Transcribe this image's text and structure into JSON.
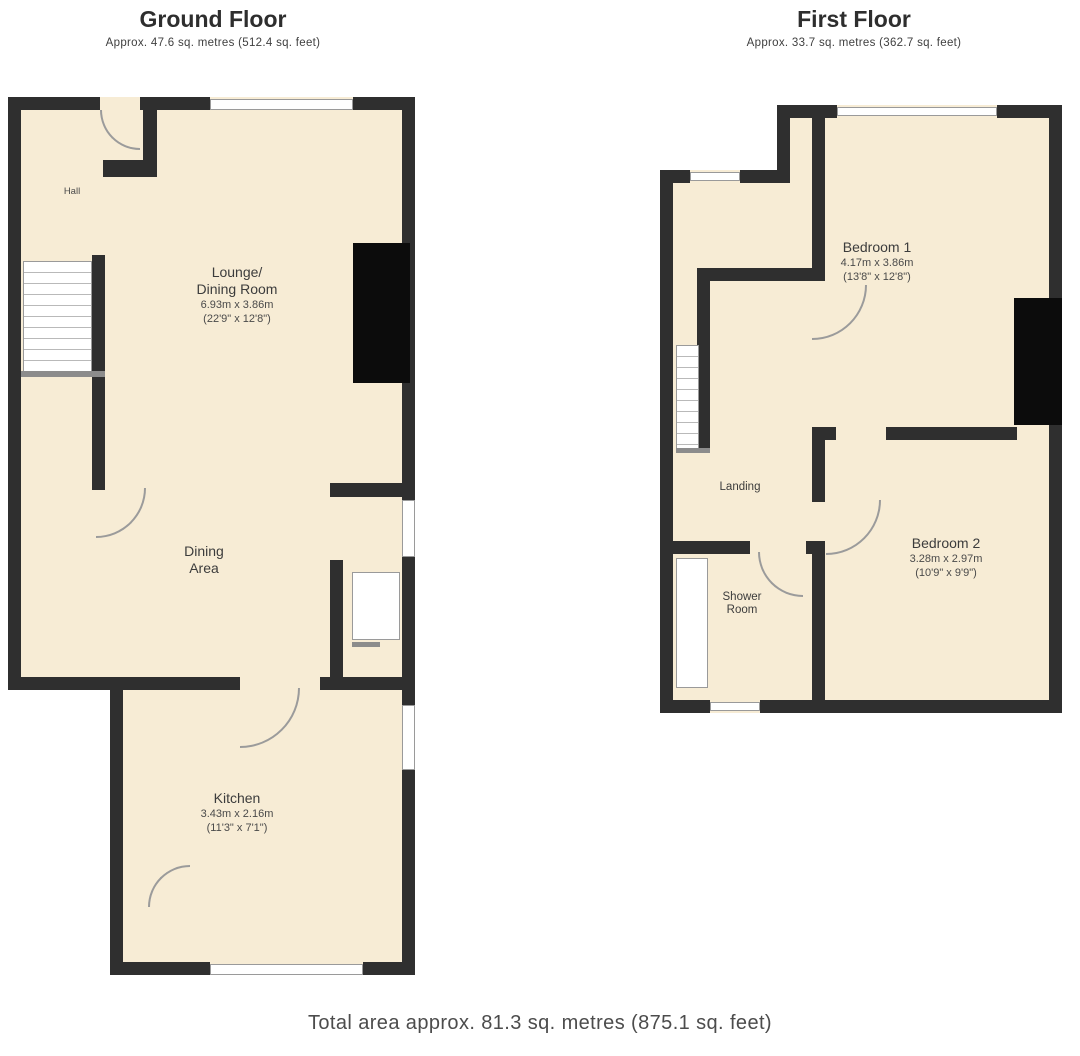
{
  "ground_floor": {
    "title": "Ground Floor",
    "subtitle": "Approx. 47.6 sq. metres (512.4 sq. feet)",
    "hall": {
      "label": "Hall"
    },
    "lounge": {
      "name_line1": "Lounge/",
      "name_line2": "Dining Room",
      "dims_metric": "6.93m x 3.86m",
      "dims_imperial": "(22'9\" x 12'8\")"
    },
    "dining_area": {
      "line1": "Dining",
      "line2": "Area"
    },
    "kitchen": {
      "name": "Kitchen",
      "dims_metric": "3.43m x 2.16m",
      "dims_imperial": "(11'3\" x 7'1\")"
    }
  },
  "first_floor": {
    "title": "First Floor",
    "subtitle": "Approx. 33.7 sq. metres (362.7 sq. feet)",
    "landing": {
      "label": "Landing"
    },
    "bedroom1": {
      "name": "Bedroom 1",
      "dims_metric": "4.17m x 3.86m",
      "dims_imperial": "(13'8\" x 12'8\")"
    },
    "bedroom2": {
      "name": "Bedroom 2",
      "dims_metric": "3.28m x 2.97m",
      "dims_imperial": "(10'9\" x 9'9\")"
    },
    "shower_room": {
      "line1": "Shower",
      "line2": "Room"
    }
  },
  "footer": {
    "total_area": "Total area approx. 81.3 sq. metres (875.1 sq. feet)"
  },
  "colors": {
    "wall": "#2f2f2f",
    "chimney": "#0c0c0c",
    "room_fill": "#f7ecd5",
    "window_frame": "#9a9a9a",
    "label_text": "#3c3c3c",
    "background": "#ffffff"
  }
}
